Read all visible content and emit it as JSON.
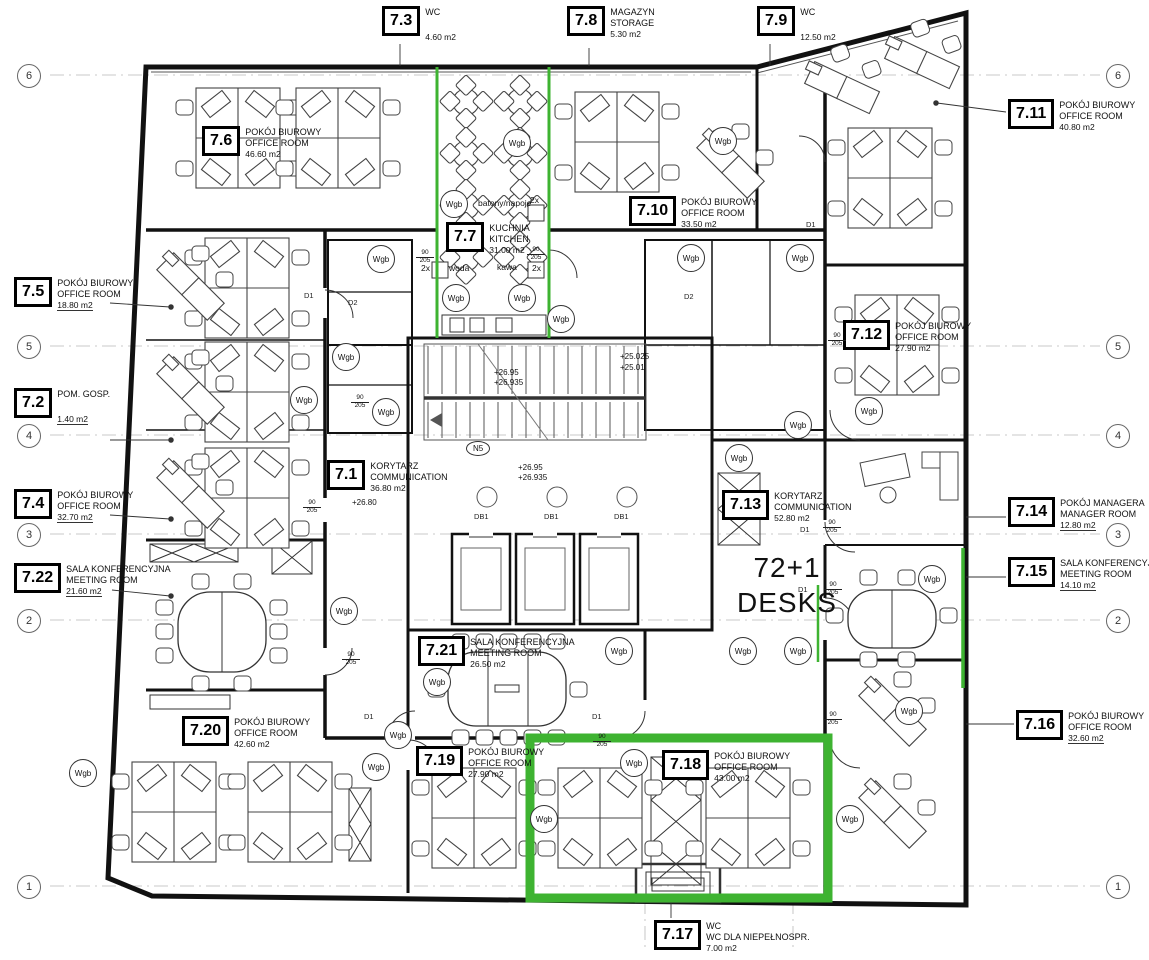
{
  "rooms": [
    {
      "num": "7.1",
      "pl": "KORYTARZ",
      "en": "COMMUNICATION",
      "area": "36.80 m2"
    },
    {
      "num": "7.2",
      "pl": "POM. GOSP.",
      "en": "",
      "area": "1.40 m2"
    },
    {
      "num": "7.3",
      "pl": "WC",
      "en": "",
      "area": "4.60 m2"
    },
    {
      "num": "7.4",
      "pl": "POKÓJ BIUROWY",
      "en": "OFFICE ROOM",
      "area": "32.70 m2"
    },
    {
      "num": "7.5",
      "pl": "POKÓJ BIUROWY",
      "en": "OFFICE ROOM",
      "area": "18.80 m2"
    },
    {
      "num": "7.6",
      "pl": "POKÓJ BIUROWY",
      "en": "OFFICE ROOM",
      "area": "46.60 m2"
    },
    {
      "num": "7.7",
      "pl": "KUCHNIA",
      "en": "KITCHEN",
      "area": "31.00 m2"
    },
    {
      "num": "7.8",
      "pl": "MAGAZYN",
      "en": "STORAGE",
      "area": "5.30 m2"
    },
    {
      "num": "7.9",
      "pl": "WC",
      "en": "",
      "area": "12.50 m2"
    },
    {
      "num": "7.10",
      "pl": "POKÓJ BIUROWY",
      "en": "OFFICE ROOM",
      "area": "33.50 m2"
    },
    {
      "num": "7.11",
      "pl": "POKÓJ BIUROWY",
      "en": "OFFICE ROOM",
      "area": "40.80 m2"
    },
    {
      "num": "7.12",
      "pl": "POKÓJ BIUROWY",
      "en": "OFFICE ROOM",
      "area": "27.90 m2"
    },
    {
      "num": "7.13",
      "pl": "KORYTARZ",
      "en": "COMMUNICATION",
      "area": "52.80 m2"
    },
    {
      "num": "7.14",
      "pl": "POKÓJ MANAGERA",
      "en": "MANAGER ROOM",
      "area": "12.80 m2"
    },
    {
      "num": "7.15",
      "pl": "SALA KONFERENCYJNA",
      "en": "MEETING ROOM",
      "area": "14.10 m2"
    },
    {
      "num": "7.16",
      "pl": "POKÓJ BIUROWY",
      "en": "OFFICE ROOM",
      "area": "32.60 m2"
    },
    {
      "num": "7.17",
      "pl": "WC",
      "en": "WC DLA NIEPEŁNOSPR.",
      "area": "7.00 m2"
    },
    {
      "num": "7.18",
      "pl": "POKÓJ BIUROWY",
      "en": "OFFICE ROOM",
      "area": "43.00 m2"
    },
    {
      "num": "7.19",
      "pl": "POKÓJ BIUROWY",
      "en": "OFFICE ROOM",
      "area": "27.90 m2"
    },
    {
      "num": "7.20",
      "pl": "POKÓJ BIUROWY",
      "en": "OFFICE ROOM",
      "area": "42.60 m2"
    },
    {
      "num": "7.21",
      "pl": "SALA KONFERENCYJNA",
      "en": "MEETING ROOM",
      "area": "26.50 m2"
    },
    {
      "num": "7.22",
      "pl": "SALA KONFERENCYJNA",
      "en": "MEETING ROOM",
      "area": "21.60 m2"
    }
  ],
  "grid": {
    "markers": [
      "6",
      "5",
      "4",
      "3",
      "2",
      "1"
    ]
  },
  "ann": {
    "wgb": "Wgb",
    "desks1": "72+1",
    "desks2": "DESKS",
    "snacks": "batony/napoje",
    "water": "woda",
    "coffee": "kawa",
    "qty": "2x",
    "lvl_a1": "+26.95",
    "lvl_a2": "+26.935",
    "lvl_b1": "+25.025",
    "lvl_b2": "+25.01",
    "lvl_c": "+26.80",
    "d1": "D1",
    "d2": "D2",
    "dsz_t": "90",
    "dsz_b": "205",
    "n5": "N5",
    "db1": "DB1"
  },
  "colors": {
    "highlight": "#3eb331",
    "wall": "#111111"
  }
}
